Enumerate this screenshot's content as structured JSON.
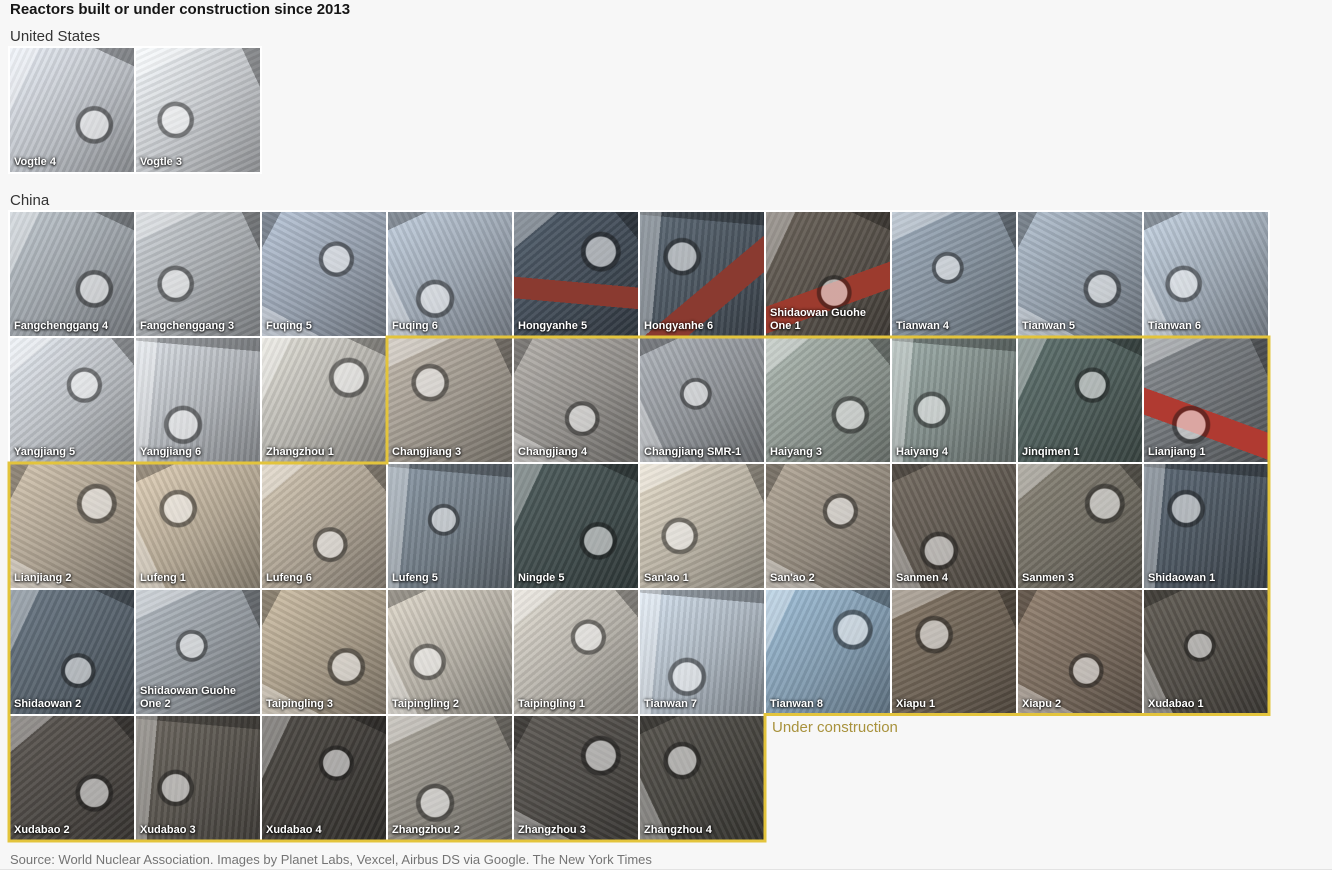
{
  "page": {
    "title": "Reactors built or under construction since 2013",
    "under_construction_label": "Under construction",
    "source": "Source: World Nuclear Association. Images by Planet Labs, Vexcel, Airbus DS via Google. The New York Times"
  },
  "colors": {
    "background": "#f7f7f7",
    "title": "#161616",
    "section": "#333333",
    "tile_label": "#ffffff",
    "under_construction_border": "#e3c43c",
    "under_construction_text": "#a8923c",
    "source_text": "#747474"
  },
  "sections": [
    {
      "label": "United States",
      "tiles": [
        {
          "name": "Vogtle 4",
          "under_construction": false,
          "tone": "#b9bdc3"
        },
        {
          "name": "Vogtle 3",
          "under_construction": false,
          "tone": "#c2c5c9"
        }
      ]
    },
    {
      "label": "China",
      "tiles": [
        {
          "name": "Fangchenggang 4",
          "under_construction": false,
          "tone": "#9aa0a6"
        },
        {
          "name": "Fangchenggang 3",
          "under_construction": false,
          "tone": "#a4a8ac"
        },
        {
          "name": "Fuqing 5",
          "under_construction": false,
          "tone": "#939dab"
        },
        {
          "name": "Fuqing 6",
          "under_construction": false,
          "tone": "#9aa4b0"
        },
        {
          "name": "Hongyanhe 5",
          "under_construction": false,
          "tone": "#414b56",
          "accent": "#8a3a30"
        },
        {
          "name": "Hongyanhe 6",
          "under_construction": false,
          "tone": "#4a545e",
          "accent": "#8a3a30"
        },
        {
          "name": "Shidaowan Guohe One 1",
          "under_construction": false,
          "tone": "#565049",
          "accent": "#9c3b2e"
        },
        {
          "name": "Tianwan 4",
          "under_construction": false,
          "tone": "#808c98"
        },
        {
          "name": "Tianwan 5",
          "under_construction": false,
          "tone": "#8e99a5"
        },
        {
          "name": "Tianwan 6",
          "under_construction": false,
          "tone": "#9ca7b3"
        },
        {
          "name": "Yangjiang 5",
          "under_construction": false,
          "tone": "#b7bbc0"
        },
        {
          "name": "Yangjiang 6",
          "under_construction": false,
          "tone": "#aeb2b7"
        },
        {
          "name": "Zhangzhou 1",
          "under_construction": false,
          "tone": "#b3b1ab"
        },
        {
          "name": "Changjiang 3",
          "under_construction": true,
          "tone": "#9b948a"
        },
        {
          "name": "Changjiang 4",
          "under_construction": true,
          "tone": "#918e8a"
        },
        {
          "name": "Changjiang SMR-1",
          "under_construction": true,
          "tone": "#8c9095"
        },
        {
          "name": "Haiyang 3",
          "under_construction": true,
          "tone": "#8b948e"
        },
        {
          "name": "Haiyang 4",
          "under_construction": true,
          "tone": "#7e8a87"
        },
        {
          "name": "Jinqimen 1",
          "under_construction": true,
          "tone": "#4c5b58"
        },
        {
          "name": "Lianjiang 1",
          "under_construction": true,
          "tone": "#6c7074",
          "accent": "#b03a31"
        },
        {
          "name": "Lianjiang 2",
          "under_construction": true,
          "tone": "#a89d8d"
        },
        {
          "name": "Lufeng 1",
          "under_construction": true,
          "tone": "#b1a592"
        },
        {
          "name": "Lufeng 6",
          "under_construction": true,
          "tone": "#a99f90"
        },
        {
          "name": "Lufeng 5",
          "under_construction": true,
          "tone": "#707b85"
        },
        {
          "name": "Ningde 5",
          "under_construction": true,
          "tone": "#3f4b4b"
        },
        {
          "name": "San'ao 1",
          "under_construction": true,
          "tone": "#b5aea0"
        },
        {
          "name": "San'ao 2",
          "under_construction": true,
          "tone": "#90877b"
        },
        {
          "name": "Sanmen 4",
          "under_construction": true,
          "tone": "#5e574f"
        },
        {
          "name": "Sanmen 3",
          "under_construction": true,
          "tone": "#6f6b61"
        },
        {
          "name": "Shidaowan 1",
          "under_construction": true,
          "tone": "#4b555f"
        },
        {
          "name": "Shidaowan 2",
          "under_construction": true,
          "tone": "#56616b"
        },
        {
          "name": "Shidaowan Guohe One 2",
          "under_construction": true,
          "tone": "#90969c"
        },
        {
          "name": "Taipingling 3",
          "under_construction": true,
          "tone": "#a49885"
        },
        {
          "name": "Taipingling 2",
          "under_construction": true,
          "tone": "#b1aca2"
        },
        {
          "name": "Taipingling 1",
          "under_construction": true,
          "tone": "#b3afa7"
        },
        {
          "name": "Tianwan 7",
          "under_construction": true,
          "tone": "#a9b3bd"
        },
        {
          "name": "Tianwan 8",
          "under_construction": true,
          "tone": "#8099ad"
        },
        {
          "name": "Xiapu 1",
          "under_construction": true,
          "tone": "#6b6053"
        },
        {
          "name": "Xiapu 2",
          "under_construction": true,
          "tone": "#76685b"
        },
        {
          "name": "Xudabao 1",
          "under_construction": true,
          "tone": "#4f4b45"
        },
        {
          "name": "Xudabao 2",
          "under_construction": true,
          "tone": "#4b4743"
        },
        {
          "name": "Xudabao 3",
          "under_construction": true,
          "tone": "#56524c"
        },
        {
          "name": "Xudabao 4",
          "under_construction": true,
          "tone": "#403d39"
        },
        {
          "name": "Zhangzhou 2",
          "under_construction": true,
          "tone": "#8b877f"
        },
        {
          "name": "Zhangzhou 3",
          "under_construction": true,
          "tone": "#4c4945"
        },
        {
          "name": "Zhangzhou 4",
          "under_construction": true,
          "tone": "#46443f"
        }
      ]
    }
  ],
  "chart_data": {
    "type": "table",
    "title": "Reactors built or under construction since 2013",
    "legend": {
      "yellow_outline_means": "Under construction"
    },
    "columns": [
      "country",
      "reactor",
      "status"
    ],
    "rows": [
      [
        "United States",
        "Vogtle 4",
        "built"
      ],
      [
        "United States",
        "Vogtle 3",
        "built"
      ],
      [
        "China",
        "Fangchenggang 4",
        "built"
      ],
      [
        "China",
        "Fangchenggang 3",
        "built"
      ],
      [
        "China",
        "Fuqing 5",
        "built"
      ],
      [
        "China",
        "Fuqing 6",
        "built"
      ],
      [
        "China",
        "Hongyanhe 5",
        "built"
      ],
      [
        "China",
        "Hongyanhe 6",
        "built"
      ],
      [
        "China",
        "Shidaowan Guohe One 1",
        "built"
      ],
      [
        "China",
        "Tianwan 4",
        "built"
      ],
      [
        "China",
        "Tianwan 5",
        "built"
      ],
      [
        "China",
        "Tianwan 6",
        "built"
      ],
      [
        "China",
        "Yangjiang 5",
        "built"
      ],
      [
        "China",
        "Yangjiang 6",
        "built"
      ],
      [
        "China",
        "Zhangzhou 1",
        "built"
      ],
      [
        "China",
        "Changjiang 3",
        "under construction"
      ],
      [
        "China",
        "Changjiang 4",
        "under construction"
      ],
      [
        "China",
        "Changjiang SMR-1",
        "under construction"
      ],
      [
        "China",
        "Haiyang 3",
        "under construction"
      ],
      [
        "China",
        "Haiyang 4",
        "under construction"
      ],
      [
        "China",
        "Jinqimen 1",
        "under construction"
      ],
      [
        "China",
        "Lianjiang 1",
        "under construction"
      ],
      [
        "China",
        "Lianjiang 2",
        "under construction"
      ],
      [
        "China",
        "Lufeng 1",
        "under construction"
      ],
      [
        "China",
        "Lufeng 6",
        "under construction"
      ],
      [
        "China",
        "Lufeng 5",
        "under construction"
      ],
      [
        "China",
        "Ningde 5",
        "under construction"
      ],
      [
        "China",
        "San'ao 1",
        "under construction"
      ],
      [
        "China",
        "San'ao 2",
        "under construction"
      ],
      [
        "China",
        "Sanmen 4",
        "under construction"
      ],
      [
        "China",
        "Sanmen 3",
        "under construction"
      ],
      [
        "China",
        "Shidaowan 1",
        "under construction"
      ],
      [
        "China",
        "Shidaowan 2",
        "under construction"
      ],
      [
        "China",
        "Shidaowan Guohe One 2",
        "under construction"
      ],
      [
        "China",
        "Taipingling 3",
        "under construction"
      ],
      [
        "China",
        "Taipingling 2",
        "under construction"
      ],
      [
        "China",
        "Taipingling 1",
        "under construction"
      ],
      [
        "China",
        "Tianwan 7",
        "under construction"
      ],
      [
        "China",
        "Tianwan 8",
        "under construction"
      ],
      [
        "China",
        "Xiapu 1",
        "under construction"
      ],
      [
        "China",
        "Xiapu 2",
        "under construction"
      ],
      [
        "China",
        "Xudabao 1",
        "under construction"
      ],
      [
        "China",
        "Xudabao 2",
        "under construction"
      ],
      [
        "China",
        "Xudabao 3",
        "under construction"
      ],
      [
        "China",
        "Xudabao 4",
        "under construction"
      ],
      [
        "China",
        "Zhangzhou 2",
        "under construction"
      ],
      [
        "China",
        "Zhangzhou 3",
        "under construction"
      ],
      [
        "China",
        "Zhangzhou 4",
        "under construction"
      ]
    ]
  }
}
